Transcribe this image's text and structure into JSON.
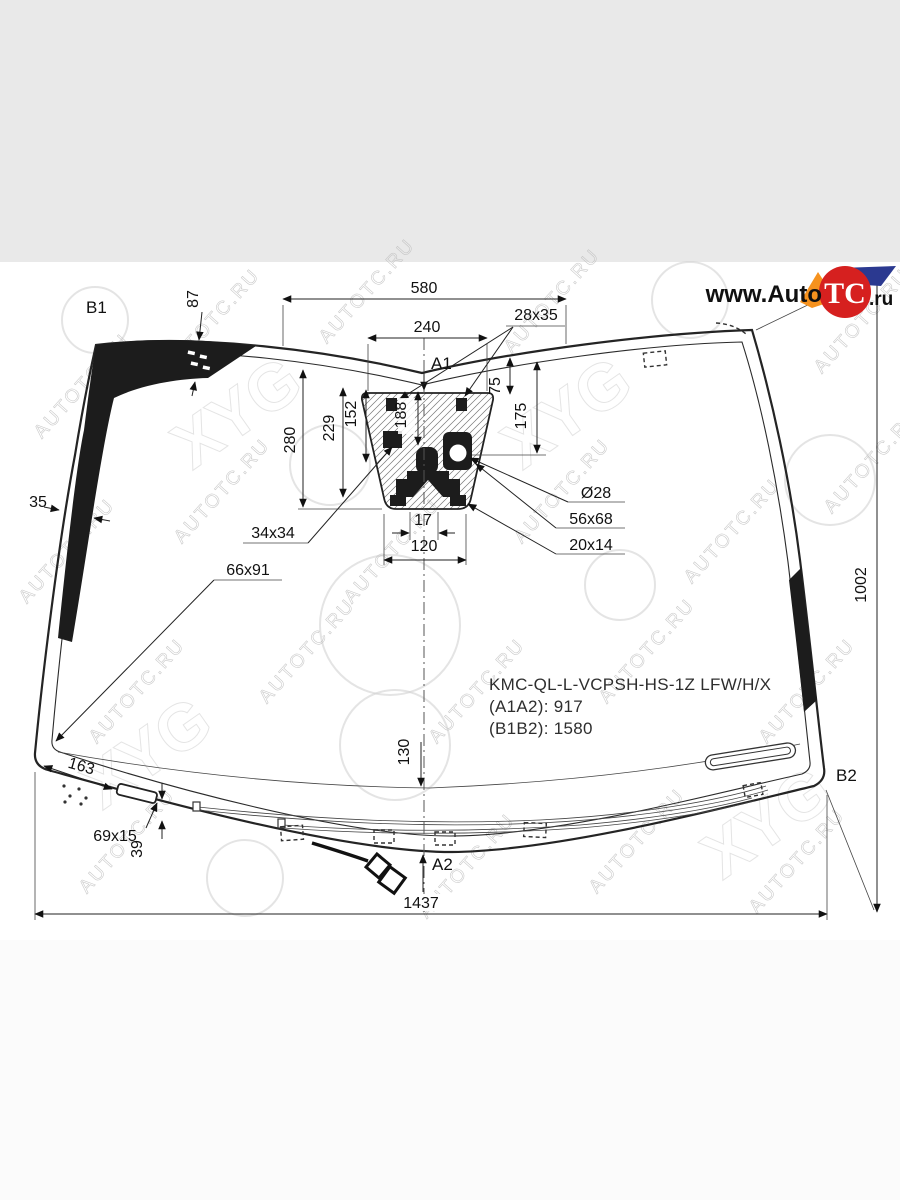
{
  "page": {
    "top_band_color": "#e9e9e9",
    "canvas_color": "#ffffff",
    "bottom_band_color": "#fbfbfb"
  },
  "logo": {
    "prefix": "www.Auto",
    "badge": "TC",
    "suffix": ".ru",
    "badge_color": "#d6201f",
    "blue_color": "#2b3990",
    "orange_color": "#f6921e"
  },
  "watermark": {
    "text": "AUTOTC.RU",
    "brand": "XYG"
  },
  "corner_labels": {
    "b1": "B1",
    "b2": "B2",
    "a1": "A1",
    "a2": "A2"
  },
  "dimensions": {
    "top_band_width": "580",
    "camera_window_width": "240",
    "bracket_28x35": "28x35",
    "band_height_87": "87",
    "offset_75": "75",
    "offset_175": "175",
    "height_280": "280",
    "height_229": "229",
    "height_152": "152",
    "height_188": "188",
    "edge_band_35": "35",
    "pad_34x34": "34x34",
    "pad_66x91": "66x91",
    "gap_17": "17",
    "width_120": "120",
    "hole_d28": "Ø28",
    "pad_56x68": "56x68",
    "pad_20x14": "20x14",
    "height_1002": "1002",
    "offset_130": "130",
    "offset_163": "163",
    "pad_69x15": "69x15",
    "offset_39": "39",
    "bottom_width_1437": "1437"
  },
  "part_info": {
    "code": "KMC-QL-L-VCPSH-HS-1Z LFW/H/X",
    "a1a2": "(A1A2): 917",
    "b1b2": "(B1B2): 1580"
  }
}
